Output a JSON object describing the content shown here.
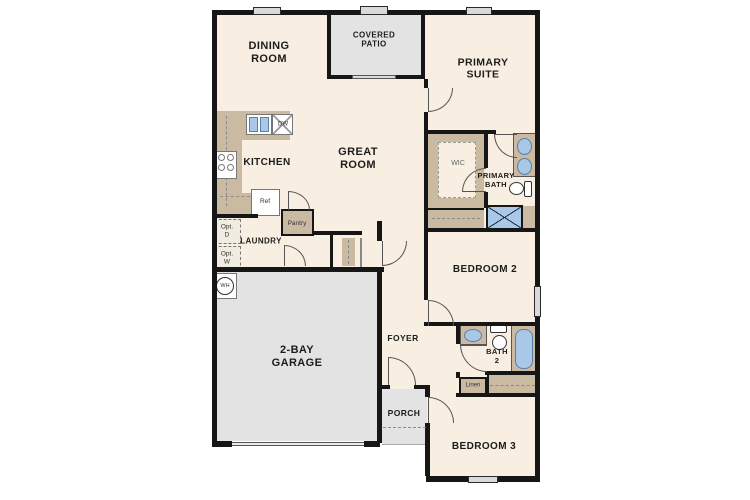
{
  "title": "Single-story floor plan",
  "labels": {
    "dining": "DINING\nROOM",
    "patio": "COVERED\nPATIO",
    "primary_suite": "PRIMARY\nSUITE",
    "kitchen": "KITCHEN",
    "great_room": "GREAT\nROOM",
    "wic": "WIC",
    "primary_bath": "PRIMARY\nBATH",
    "bedroom2": "BEDROOM 2",
    "bath2": "BATH\n2",
    "linen": "Linen",
    "bedroom3": "BEDROOM 3",
    "foyer": "FOYER",
    "porch": "PORCH",
    "garage": "2-BAY\nGARAGE",
    "laundry": "LAUNDRY",
    "pantry": "Pantry",
    "dishwasher": "DW",
    "refrigerator": "Ref",
    "water_heater": "WH",
    "opt_dryer": "Opt.\nD",
    "opt_washer": "Opt.\nW"
  },
  "colors": {
    "room_fill": "#f8efe2",
    "outdoor_fill": "#e3e3e3",
    "cabinetry_fill": "#cbbaa2",
    "fixture_blue": "#a9c7e6",
    "wall": "#161616"
  }
}
